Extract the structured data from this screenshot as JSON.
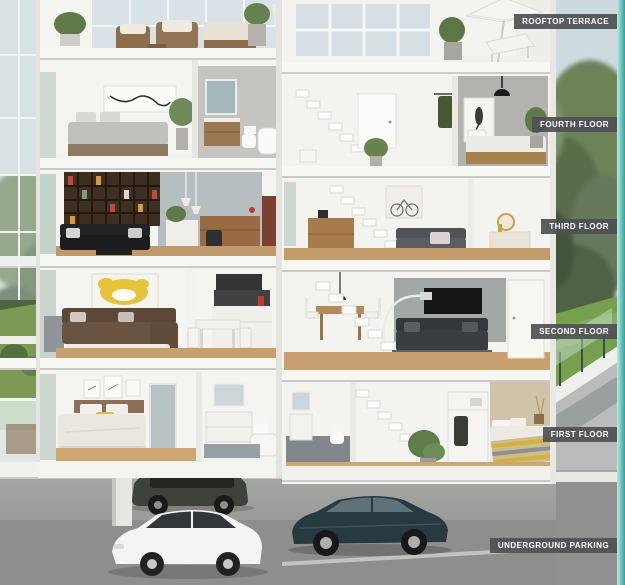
{
  "page": {
    "title": "Building cross-section"
  },
  "floor_labels": [
    {
      "id": "rooftop-terrace",
      "text": "ROOFTOP TERRACE"
    },
    {
      "id": "fourth-floor",
      "text": "FOURTH FLOOR"
    },
    {
      "id": "third-floor",
      "text": "THIRD FLOOR"
    },
    {
      "id": "second-floor",
      "text": "SECOND FLOOR"
    },
    {
      "id": "first-floor",
      "text": "FIRST FLOOR"
    },
    {
      "id": "underground-parking",
      "text": "UNDERGROUND PARKING"
    }
  ],
  "colors": {
    "accent_teal": "#2aa69c",
    "badge_bg": "rgba(79,81,84,0.93)",
    "badge_text": "#ffffff"
  }
}
